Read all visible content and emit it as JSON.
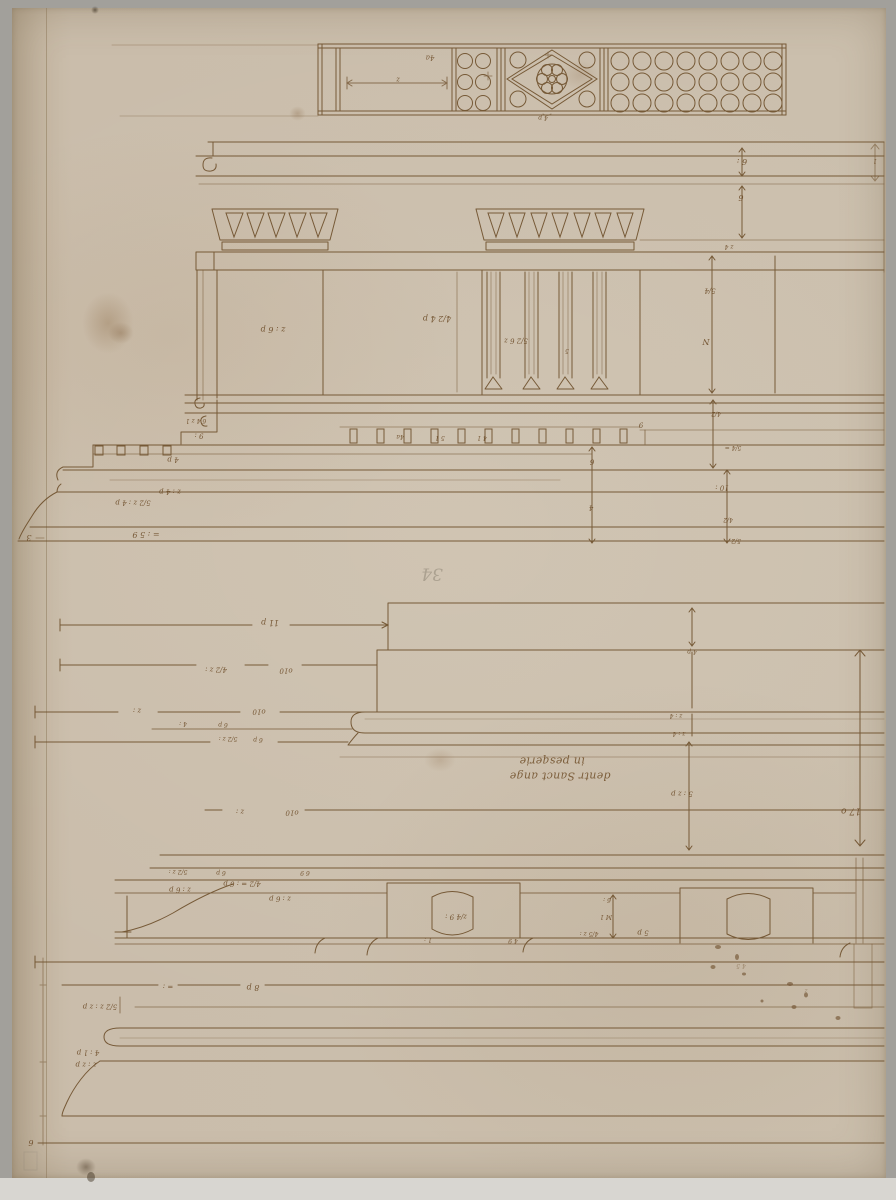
{
  "palette": {
    "mount": "#a2a09b",
    "mount_bottom": "#d8d6d1",
    "paper": "#cbbfad",
    "ink": "#6b4a26",
    "graphite": "#8f8676"
  },
  "inscription": {
    "line_top": "in pesqerie",
    "line_bottom": "dentr Sanct ange"
  },
  "annotations": [
    {
      "x": 398,
      "y": 79,
      "t": "z",
      "s": 7
    },
    {
      "x": 430,
      "y": 57,
      "t": "4a",
      "s": 7
    },
    {
      "x": 543,
      "y": 117,
      "t": "4 p",
      "s": 6
    },
    {
      "x": 742,
      "y": 161,
      "t": "6 :",
      "s": 8
    },
    {
      "x": 741,
      "y": 197,
      "t": "6",
      "s": 8
    },
    {
      "x": 729,
      "y": 246,
      "t": "z 4",
      "s": 6
    },
    {
      "x": 710,
      "y": 290,
      "t": "5/4",
      "s": 7
    },
    {
      "x": 706,
      "y": 341,
      "t": "N",
      "s": 8
    },
    {
      "x": 273,
      "y": 329,
      "t": "z : 6 p",
      "s": 8
    },
    {
      "x": 437,
      "y": 318,
      "t": "4/2 4 p",
      "s": 8
    },
    {
      "x": 516,
      "y": 340,
      "t": "5/2 6 z",
      "s": 7
    },
    {
      "x": 567,
      "y": 350,
      "t": "5",
      "s": 6
    },
    {
      "x": 400,
      "y": 436,
      "t": "4a",
      "s": 6
    },
    {
      "x": 440,
      "y": 437,
      "t": "5 1",
      "s": 6
    },
    {
      "x": 482,
      "y": 437,
      "t": "4 1",
      "s": 6
    },
    {
      "x": 196,
      "y": 420,
      "t": "6 4 z 1",
      "s": 6
    },
    {
      "x": 199,
      "y": 435,
      "t": "9 :",
      "s": 7
    },
    {
      "x": 173,
      "y": 459,
      "t": "4 p",
      "s": 7
    },
    {
      "x": 170,
      "y": 491,
      "t": "z : 4 p",
      "s": 7
    },
    {
      "x": 133,
      "y": 502,
      "t": "5/2 z : 4 p",
      "s": 7
    },
    {
      "x": 146,
      "y": 534,
      "t": "= : 5 9",
      "s": 8
    },
    {
      "x": 592,
      "y": 461,
      "t": "6",
      "s": 7
    },
    {
      "x": 591,
      "y": 507,
      "t": "4",
      "s": 7
    },
    {
      "x": 716,
      "y": 413,
      "t": "4/2",
      "s": 6
    },
    {
      "x": 733,
      "y": 447,
      "t": "5/4 =",
      "s": 6
    },
    {
      "x": 722,
      "y": 487,
      "t": "10 :",
      "s": 7
    },
    {
      "x": 728,
      "y": 519,
      "t": "4/2",
      "s": 6
    },
    {
      "x": 736,
      "y": 540,
      "t": "5/2",
      "s": 6
    },
    {
      "x": 641,
      "y": 424,
      "t": "9",
      "s": 7
    },
    {
      "x": 875,
      "y": 160,
      "t": "1",
      "s": 6
    },
    {
      "x": 432,
      "y": 573,
      "t": "34",
      "s": 17,
      "c": "graphite"
    },
    {
      "x": 29,
      "y": 537,
      "t": "3",
      "s": 8
    },
    {
      "x": 270,
      "y": 622,
      "t": "11 p",
      "s": 8
    },
    {
      "x": 216,
      "y": 669,
      "t": "4/2 z :",
      "s": 7
    },
    {
      "x": 286,
      "y": 670,
      "t": "o10",
      "s": 7
    },
    {
      "x": 137,
      "y": 710,
      "t": "z :",
      "s": 7
    },
    {
      "x": 259,
      "y": 711,
      "t": "o10",
      "s": 7
    },
    {
      "x": 183,
      "y": 723,
      "t": "4 :",
      "s": 6
    },
    {
      "x": 223,
      "y": 724,
      "t": "6 p",
      "s": 6
    },
    {
      "x": 228,
      "y": 738,
      "t": "5/2 z :",
      "s": 6
    },
    {
      "x": 258,
      "y": 739,
      "t": "6 p",
      "s": 6
    },
    {
      "x": 240,
      "y": 811,
      "t": "z :",
      "s": 7
    },
    {
      "x": 292,
      "y": 812,
      "t": "o10",
      "s": 7
    },
    {
      "x": 178,
      "y": 871,
      "t": "5/2 z :",
      "s": 6
    },
    {
      "x": 221,
      "y": 872,
      "t": "6 p",
      "s": 6
    },
    {
      "x": 305,
      "y": 872,
      "t": "6 9",
      "s": 6
    },
    {
      "x": 180,
      "y": 889,
      "t": "z : 6 p",
      "s": 7
    },
    {
      "x": 242,
      "y": 883,
      "t": "4/2 = : 6 p",
      "s": 7
    },
    {
      "x": 280,
      "y": 898,
      "t": "z : 6 p",
      "s": 7
    },
    {
      "x": 168,
      "y": 986,
      "t": "= :",
      "s": 7
    },
    {
      "x": 253,
      "y": 987,
      "t": "8 p",
      "s": 8
    },
    {
      "x": 100,
      "y": 1006,
      "t": "5/2 z : z p",
      "s": 7
    },
    {
      "x": 88,
      "y": 1052,
      "t": "4 : 1 p",
      "s": 7
    },
    {
      "x": 86,
      "y": 1064,
      "t": "z : z p",
      "s": 7
    },
    {
      "x": 31,
      "y": 1142,
      "t": "6",
      "s": 8
    },
    {
      "x": 692,
      "y": 651,
      "t": "4 p",
      "s": 6
    },
    {
      "x": 676,
      "y": 715,
      "t": "z : 4",
      "s": 6
    },
    {
      "x": 679,
      "y": 733,
      "t": "z : 4",
      "s": 6
    },
    {
      "x": 682,
      "y": 793,
      "t": "5 : z p",
      "s": 7
    },
    {
      "x": 851,
      "y": 810,
      "t": "17 o",
      "s": 9
    },
    {
      "x": 607,
      "y": 899,
      "t": "6 :",
      "s": 6
    },
    {
      "x": 606,
      "y": 916,
      "t": "M 1",
      "s": 6
    },
    {
      "x": 589,
      "y": 933,
      "t": "4/5 z :",
      "s": 6
    },
    {
      "x": 643,
      "y": 932,
      "t": "5 p",
      "s": 7
    },
    {
      "x": 456,
      "y": 916,
      "t": "z/4 9 :",
      "s": 7
    },
    {
      "x": 428,
      "y": 939,
      "t": "1 :",
      "s": 6
    },
    {
      "x": 513,
      "y": 940,
      "t": "4 9",
      "s": 6
    },
    {
      "x": 741,
      "y": 965,
      "t": "4 5",
      "s": 6,
      "o": 0.45
    },
    {
      "x": 806,
      "y": 990,
      "t": "z",
      "s": 6,
      "o": 0.4
    },
    {
      "x": 552,
      "y": 761,
      "t": "in pesqerie",
      "s": 11,
      "c": "script"
    },
    {
      "x": 560,
      "y": 776,
      "t": "dentr Sanct ange",
      "s": 11,
      "c": "script"
    }
  ]
}
